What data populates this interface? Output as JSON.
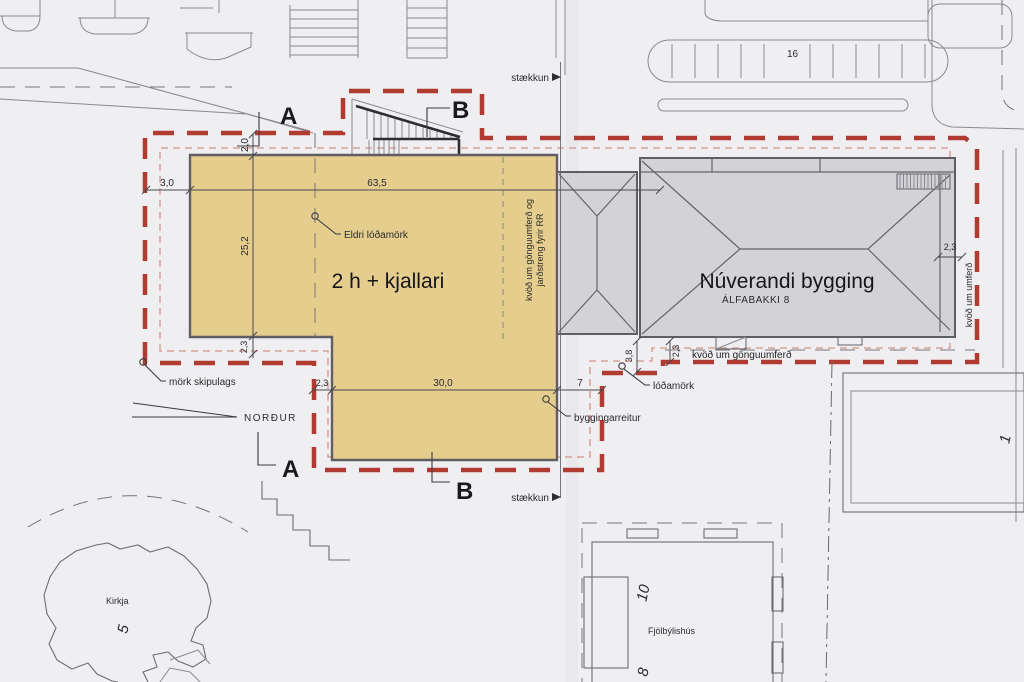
{
  "plan": {
    "title_hint": "site plan drawing",
    "labels": {
      "section_a": "A",
      "section_b": "B",
      "staekkun": "stækkun",
      "eldri_lodamork": "Eldri lóðamörk",
      "building_new": "2 h + kjallari",
      "building_existing": "Núverandi bygging",
      "building_existing_sub": "ÁLFABAKKI 8",
      "mork_skipulags": "mörk skipulags",
      "nordur": "NORÐUR",
      "kvod_strip_line1": "kvöð um gönguumferð og",
      "kvod_strip_line2": "jarðstreng fyrir RR",
      "kvod_gonguumferd": "kvöð um gönguumferð",
      "kvod_umferd": "kvöð um umferð",
      "lodamork": "lóðamörk",
      "byggingarreitur": "byggingarreitur",
      "kirkja": "Kirkja",
      "fjolbylishus": "Fjölbýlishús"
    },
    "numbers": {
      "parking_spaces": "16",
      "kirkja_no": "5",
      "fjol_no_10": "10",
      "fjol_no_8": "8",
      "bottom_right_no": "1"
    },
    "dimensions": {
      "left_offset": "3,0",
      "top_width": "63,5",
      "top_gap": "2,0",
      "left_height": "25,2",
      "left_step": "2,3",
      "wing_offset": "2,3",
      "wing_width": "30,0",
      "wing_gap": "7",
      "south_gap": "3,8",
      "south_strip": "2,3",
      "east_gap": "2,3"
    },
    "colors": {
      "site_boundary_red": "#b23b31",
      "building_envelope_pink": "#d4938b",
      "new_building_fill": "#e5cd8d",
      "existing_building_fill": "#d3d2d7",
      "paper": "#efeef1",
      "linework": "#6f6d74"
    }
  }
}
